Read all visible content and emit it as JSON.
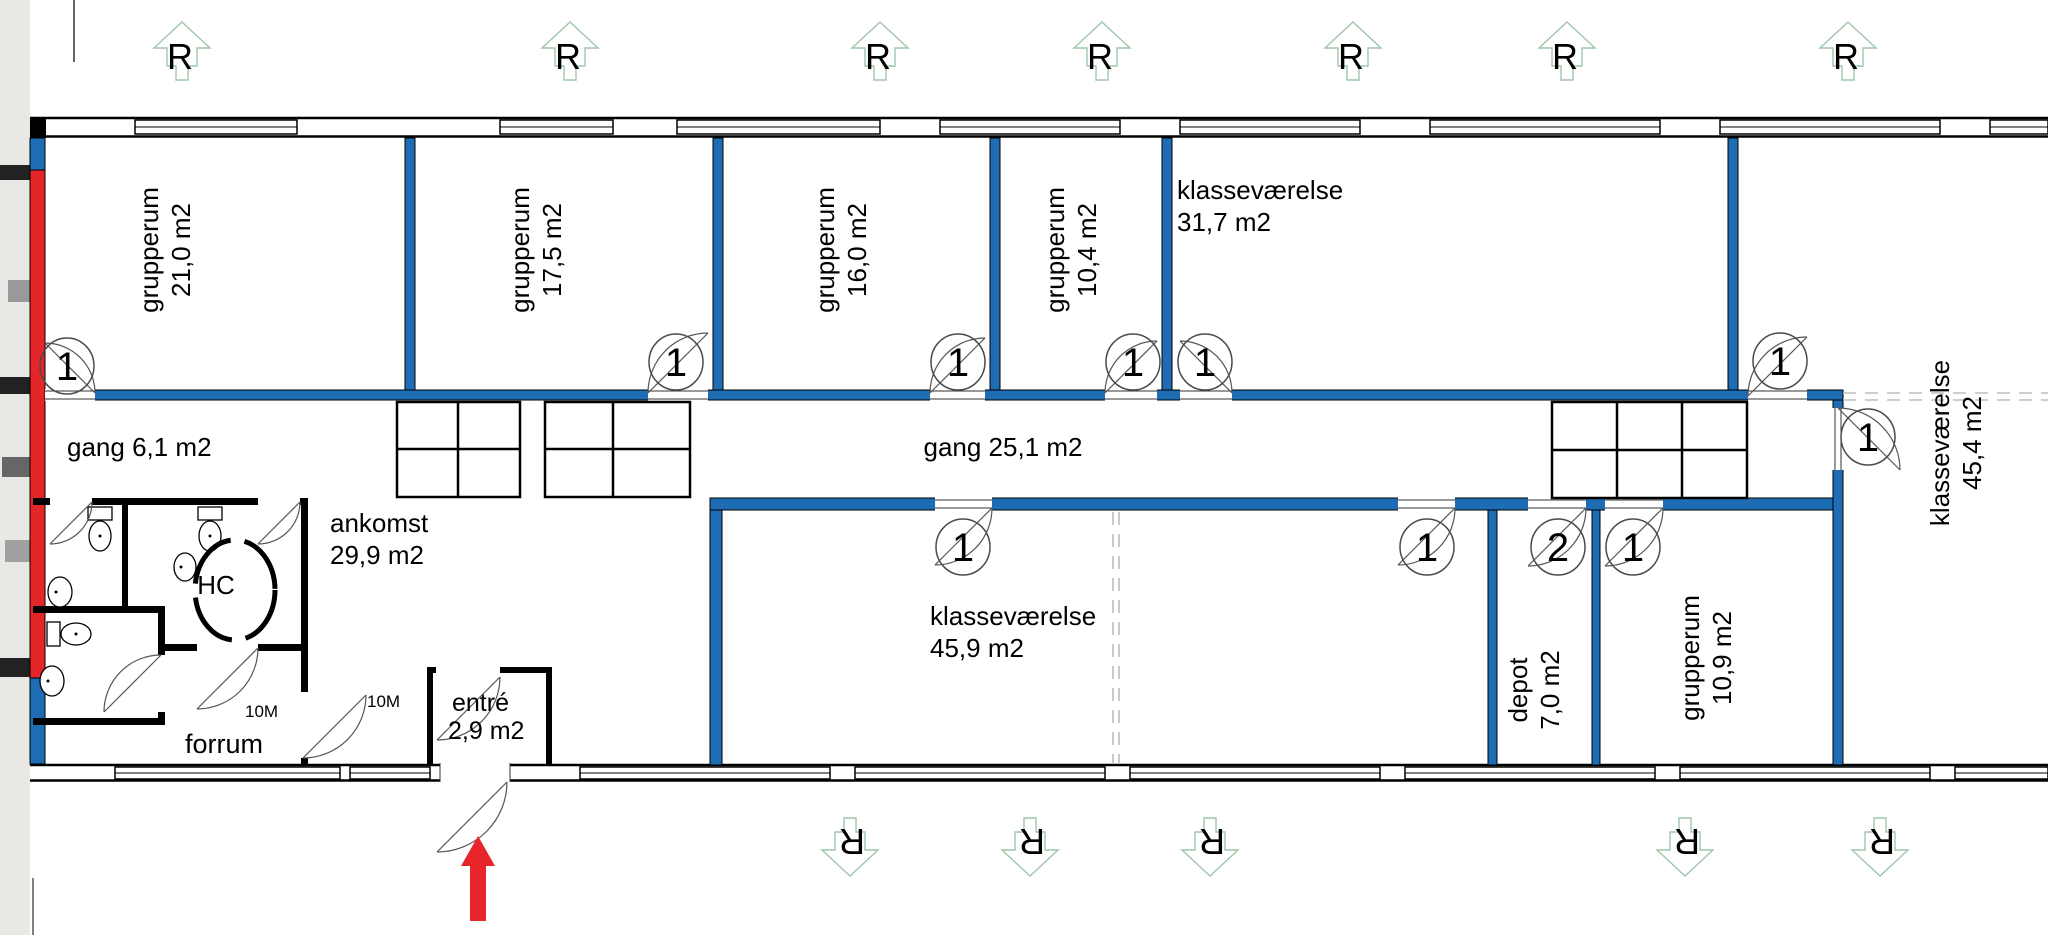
{
  "colors": {
    "wall_blue": "#1d6cb4",
    "wall_red": "#e52629",
    "roof_symbol_green": "#9fc6a9",
    "arrow_red": "#e8252a",
    "dashed_gray": "#bdbdbd"
  },
  "roof_letter": "R",
  "door_width_label": "10M",
  "doors": [
    "1",
    "1",
    "1",
    "1",
    "1",
    "1",
    "1",
    "1",
    "1",
    "2",
    "1"
  ],
  "rooms": {
    "grupperum_1": {
      "name": "grupperum",
      "area": "21,0 m2"
    },
    "grupperum_2": {
      "name": "grupperum",
      "area": "17,5 m2"
    },
    "grupperum_3": {
      "name": "grupperum",
      "area": "16,0 m2"
    },
    "grupperum_4": {
      "name": "grupperum",
      "area": "10,4 m2"
    },
    "klasse_1": {
      "name": "klasseværelse",
      "area": "31,7 m2"
    },
    "klasse_2": {
      "name": "klasseværelse",
      "area": "45,4 m2"
    },
    "klasse_3": {
      "name": "klasseværelse",
      "area": "45,9 m2"
    },
    "depot": {
      "name": "depot",
      "area": "7,0 m2"
    },
    "grupperum_5": {
      "name": "grupperum",
      "area": "10,9 m2"
    },
    "gang_1": {
      "name": "gang 6,1 m2"
    },
    "gang_2": {
      "name": "gang 25,1 m2"
    },
    "ankomst": {
      "name": "ankomst",
      "area": "29,9 m2"
    },
    "entre": {
      "name": "entré",
      "area": "2,9 m2"
    },
    "forrum": {
      "name": "forrum"
    },
    "hc": {
      "name": "HC"
    }
  }
}
